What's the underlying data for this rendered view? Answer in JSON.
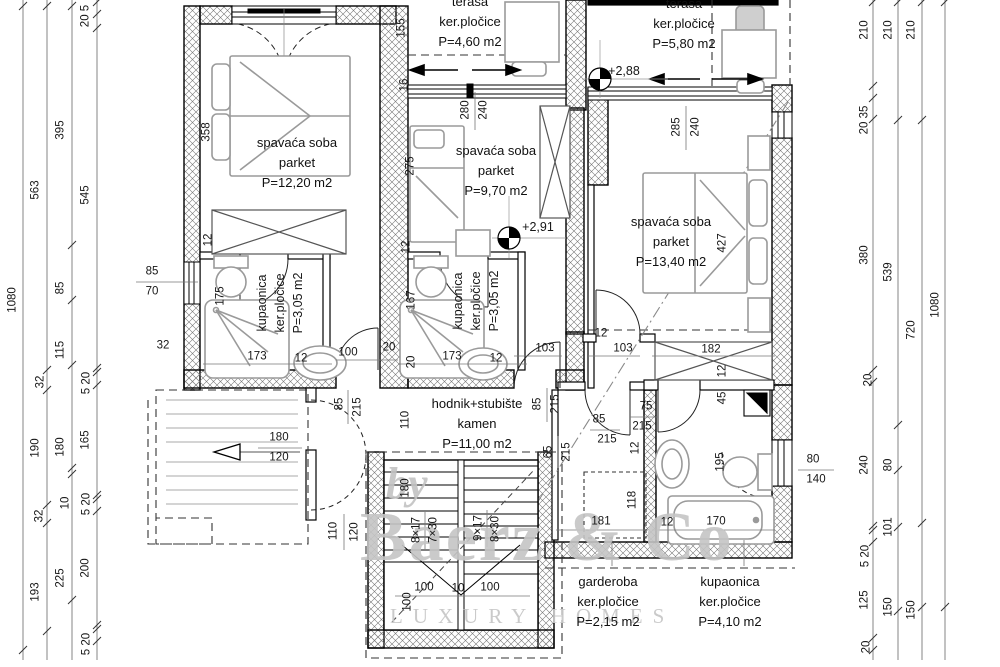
{
  "watermark": {
    "by": "by",
    "brand": "Baerz & Co",
    "tagline": "LUXURY HOMES"
  },
  "elevations": [
    {
      "text": "+2,88",
      "x": 624,
      "y": 71
    },
    {
      "text": "+2,91",
      "x": 538,
      "y": 227
    }
  ],
  "rooms": [
    {
      "id": "bedroom-1",
      "lines": [
        "spavaća soba",
        "parket",
        "P=12,20 m2"
      ],
      "x": 297,
      "y": 133,
      "rot": 0
    },
    {
      "id": "bedroom-2",
      "lines": [
        "spavaća soba",
        "parket",
        "P=9,70 m2"
      ],
      "x": 496,
      "y": 141,
      "rot": 0
    },
    {
      "id": "bedroom-3",
      "lines": [
        "spavaća soba",
        "parket",
        "P=13,40 m2"
      ],
      "x": 671,
      "y": 212,
      "rot": 0
    },
    {
      "id": "terrace-1",
      "lines": [
        "terasa",
        "ker.pločice",
        "P=4,60 m2"
      ],
      "x": 470,
      "y": -8,
      "rot": 0
    },
    {
      "id": "terrace-2",
      "lines": [
        "terasa",
        "ker.pločice",
        "P=5,80 m2"
      ],
      "x": 684,
      "y": -6,
      "rot": 0
    },
    {
      "id": "hallway",
      "lines": [
        "hodnik+stubište",
        "kamen",
        "P=11,00 m2"
      ],
      "x": 477,
      "y": 394,
      "rot": 0
    },
    {
      "id": "bathroom-1",
      "lines": [
        "kupaonica",
        "ker.pločice",
        "P=3,05 m2"
      ],
      "x": 262,
      "y": 303,
      "rot": -90
    },
    {
      "id": "bathroom-2",
      "lines": [
        "kupaonica",
        "ker.pločice",
        "P=3,05 m2"
      ],
      "x": 458,
      "y": 301,
      "rot": -90
    },
    {
      "id": "wardrobe",
      "lines": [
        "garderoba",
        "ker.pločice",
        "P=2,15 m2"
      ],
      "x": 608,
      "y": 572,
      "rot": 0
    },
    {
      "id": "bathroom-3",
      "lines": [
        "kupaonica",
        "ker.pločice",
        "P=4,10 m2"
      ],
      "x": 730,
      "y": 572,
      "rot": 0
    }
  ],
  "dim_labels": [
    {
      "t": "1080",
      "x": 13,
      "y": 300,
      "r": -90
    },
    {
      "t": "563",
      "x": 36,
      "y": 190,
      "r": -90
    },
    {
      "t": "32",
      "x": 41,
      "y": 382,
      "r": -90
    },
    {
      "t": "190",
      "x": 36,
      "y": 448,
      "r": -90
    },
    {
      "t": "32",
      "x": 40,
      "y": 516,
      "r": -90
    },
    {
      "t": "193",
      "x": 36,
      "y": 592,
      "r": -90
    },
    {
      "t": "395",
      "x": 61,
      "y": 130,
      "r": -90
    },
    {
      "t": "85",
      "x": 61,
      "y": 288,
      "r": -90
    },
    {
      "t": "115",
      "x": 61,
      "y": 350,
      "r": -90
    },
    {
      "t": "180",
      "x": 61,
      "y": 447,
      "r": -90
    },
    {
      "t": "10",
      "x": 66,
      "y": 503,
      "r": -90
    },
    {
      "t": "225",
      "x": 61,
      "y": 578,
      "r": -90
    },
    {
      "t": "20 5",
      "x": 86,
      "y": 16,
      "r": -90
    },
    {
      "t": "545",
      "x": 86,
      "y": 195,
      "r": -90
    },
    {
      "t": "5 20",
      "x": 87,
      "y": 383,
      "r": -90
    },
    {
      "t": "165",
      "x": 86,
      "y": 440,
      "r": -90
    },
    {
      "t": "5 20",
      "x": 87,
      "y": 504,
      "r": -90
    },
    {
      "t": "200",
      "x": 86,
      "y": 568,
      "r": -90
    },
    {
      "t": "5 20",
      "x": 87,
      "y": 644,
      "r": -90
    },
    {
      "t": "210",
      "x": 865,
      "y": 30,
      "r": -90
    },
    {
      "t": "20 35",
      "x": 865,
      "y": 120,
      "r": -90
    },
    {
      "t": "380",
      "x": 865,
      "y": 255,
      "r": -90
    },
    {
      "t": "20",
      "x": 869,
      "y": 380,
      "r": -90
    },
    {
      "t": "240",
      "x": 865,
      "y": 465,
      "r": -90
    },
    {
      "t": "5 20",
      "x": 866,
      "y": 556,
      "r": -90
    },
    {
      "t": "125",
      "x": 865,
      "y": 600,
      "r": -90
    },
    {
      "t": "20",
      "x": 867,
      "y": 647,
      "r": -90
    },
    {
      "t": "210",
      "x": 889,
      "y": 30,
      "r": -90
    },
    {
      "t": "539",
      "x": 889,
      "y": 272,
      "r": -90
    },
    {
      "t": "80",
      "x": 889,
      "y": 465,
      "r": -90
    },
    {
      "t": "101",
      "x": 889,
      "y": 527,
      "r": -90
    },
    {
      "t": "150",
      "x": 889,
      "y": 607,
      "r": -90
    },
    {
      "t": "210",
      "x": 912,
      "y": 30,
      "r": -90
    },
    {
      "t": "720",
      "x": 912,
      "y": 330,
      "r": -90
    },
    {
      "t": "150",
      "x": 912,
      "y": 610,
      "r": -90
    },
    {
      "t": "1080",
      "x": 936,
      "y": 305,
      "r": -90
    }
  ],
  "plan_labels": [
    {
      "t": "358",
      "x": 207,
      "y": 132,
      "r": -90
    },
    {
      "t": "12",
      "x": 209,
      "y": 240,
      "r": -90
    },
    {
      "t": "175",
      "x": 221,
      "y": 296,
      "r": -90
    },
    {
      "t": "173",
      "x": 257,
      "y": 357
    },
    {
      "t": "12",
      "x": 301,
      "y": 359
    },
    {
      "t": "85",
      "x": 152,
      "y": 272
    },
    {
      "t": "70",
      "x": 152,
      "y": 292
    },
    {
      "t": "32",
      "x": 163,
      "y": 346
    },
    {
      "t": "100",
      "x": 348,
      "y": 353
    },
    {
      "t": "20",
      "x": 389,
      "y": 348
    },
    {
      "t": "167",
      "x": 412,
      "y": 300,
      "r": -90
    },
    {
      "t": "20",
      "x": 412,
      "y": 362,
      "r": -90
    },
    {
      "t": "173",
      "x": 452,
      "y": 357
    },
    {
      "t": "12",
      "x": 496,
      "y": 359
    },
    {
      "t": "155",
      "x": 402,
      "y": 28,
      "r": -90
    },
    {
      "t": "16",
      "x": 405,
      "y": 85,
      "r": -90
    },
    {
      "t": "275",
      "x": 411,
      "y": 166,
      "r": -90
    },
    {
      "t": "12",
      "x": 407,
      "y": 247,
      "r": -90
    },
    {
      "t": "280",
      "x": 466,
      "y": 110,
      "r": -90
    },
    {
      "t": "240",
      "x": 484,
      "y": 110,
      "r": -90
    },
    {
      "t": "285",
      "x": 677,
      "y": 127,
      "r": -90
    },
    {
      "t": "240",
      "x": 696,
      "y": 127,
      "r": -90
    },
    {
      "t": "427",
      "x": 723,
      "y": 243,
      "r": -90
    },
    {
      "t": "110",
      "x": 406,
      "y": 420,
      "r": -90
    },
    {
      "t": "85",
      "x": 538,
      "y": 404,
      "r": -90
    },
    {
      "t": "215",
      "x": 556,
      "y": 404,
      "r": -90
    },
    {
      "t": "65",
      "x": 549,
      "y": 452,
      "r": -90
    },
    {
      "t": "215",
      "x": 567,
      "y": 452,
      "r": -90
    },
    {
      "t": "85",
      "x": 599,
      "y": 420
    },
    {
      "t": "215",
      "x": 607,
      "y": 440
    },
    {
      "t": "75",
      "x": 646,
      "y": 407
    },
    {
      "t": "215",
      "x": 642,
      "y": 427
    },
    {
      "t": "12",
      "x": 636,
      "y": 448,
      "r": -90
    },
    {
      "t": "12",
      "x": 601,
      "y": 334
    },
    {
      "t": "103",
      "x": 545,
      "y": 349
    },
    {
      "t": "103",
      "x": 623,
      "y": 349
    },
    {
      "t": "182",
      "x": 711,
      "y": 350
    },
    {
      "t": "12",
      "x": 723,
      "y": 371,
      "r": -90
    },
    {
      "t": "45",
      "x": 723,
      "y": 398,
      "r": -90
    },
    {
      "t": "195",
      "x": 721,
      "y": 462,
      "r": -90
    },
    {
      "t": "80",
      "x": 813,
      "y": 460
    },
    {
      "t": "140",
      "x": 816,
      "y": 480
    },
    {
      "t": "118",
      "x": 633,
      "y": 500,
      "r": -90
    },
    {
      "t": "181",
      "x": 601,
      "y": 522
    },
    {
      "t": "12",
      "x": 667,
      "y": 523
    },
    {
      "t": "170",
      "x": 716,
      "y": 522
    },
    {
      "t": "180",
      "x": 279,
      "y": 438
    },
    {
      "t": "120",
      "x": 279,
      "y": 458
    },
    {
      "t": "85",
      "x": 340,
      "y": 404,
      "r": -90
    },
    {
      "t": "215",
      "x": 358,
      "y": 407,
      "r": -90
    },
    {
      "t": "110",
      "x": 334,
      "y": 531,
      "r": -90
    },
    {
      "t": "120",
      "x": 355,
      "y": 532,
      "r": -90
    },
    {
      "t": "180",
      "x": 406,
      "y": 488,
      "r": -90
    },
    {
      "t": "100",
      "x": 408,
      "y": 602,
      "r": -90
    },
    {
      "t": "8×17",
      "x": 417,
      "y": 530,
      "r": -90
    },
    {
      "t": "7×30",
      "x": 434,
      "y": 530,
      "r": -90
    },
    {
      "t": "9×17",
      "x": 479,
      "y": 528,
      "r": -90
    },
    {
      "t": "8×30",
      "x": 496,
      "y": 529,
      "r": -90
    },
    {
      "t": "100",
      "x": 424,
      "y": 588
    },
    {
      "t": "10",
      "x": 458,
      "y": 589
    },
    {
      "t": "100",
      "x": 490,
      "y": 588
    }
  ]
}
